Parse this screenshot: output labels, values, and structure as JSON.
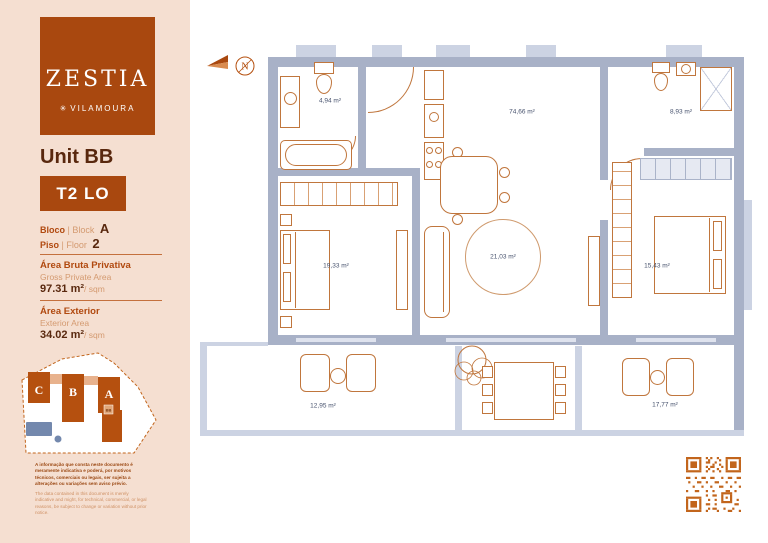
{
  "sidebar": {
    "logo": {
      "brand": "ZESTIA",
      "flower": "✳",
      "location": "VILAMOURA"
    },
    "unit_title": "Unit BB",
    "type_badge": "T2 LO",
    "bloco": {
      "pt": "Bloco",
      "mid": "| Block",
      "value": "A"
    },
    "piso": {
      "pt": "Piso",
      "mid": "| Floor",
      "value": "2"
    },
    "gross": {
      "pt": "Área Bruta Privativa",
      "en": "Gross Private Area",
      "value": "97.31 m²",
      "suffix": "/ sqm"
    },
    "exterior": {
      "pt": "Área Exterior",
      "en": "Exterior Area",
      "value": "34.02 m²",
      "suffix": "/ sqm"
    },
    "siteplan": {
      "block_c": "C",
      "block_b": "B",
      "block_a": "A",
      "marker": "BB"
    },
    "disclaimer_pt": "A informação que consta neste documento é meramente indicativa e poderá, por motivos técnicos, comerciais ou legais, ser sujeita a alterações ou variações sem aviso prévio.",
    "disclaimer_en": "The data contained in this document is merely indicative and might, for technical, commercial, or legal reasons, be subject to change or variation without prior notice."
  },
  "plan": {
    "compass_n": "N",
    "areas": {
      "bathroom1": "4,94 m²",
      "living": "74,66 m²",
      "bathroom2": "8,93 m²",
      "bedroom1": "19,33 m²",
      "rug": "21,03 m²",
      "bedroom2": "15,43 m²",
      "terrace1": "12,95 m²",
      "terrace2": "17,77 m²"
    }
  },
  "colors": {
    "accent_orange": "#a9480f",
    "text_brown": "#59280e",
    "text_light_orange": "#d49a70",
    "wall": "#a8b1c7",
    "wall_light": "#ccd3e3",
    "furniture": "#c0763d",
    "room_label": "#47526d",
    "pool_blue": "#7388ad",
    "qr_orange": "#c2651c",
    "sidebar_bg": "#f5dfd1"
  }
}
